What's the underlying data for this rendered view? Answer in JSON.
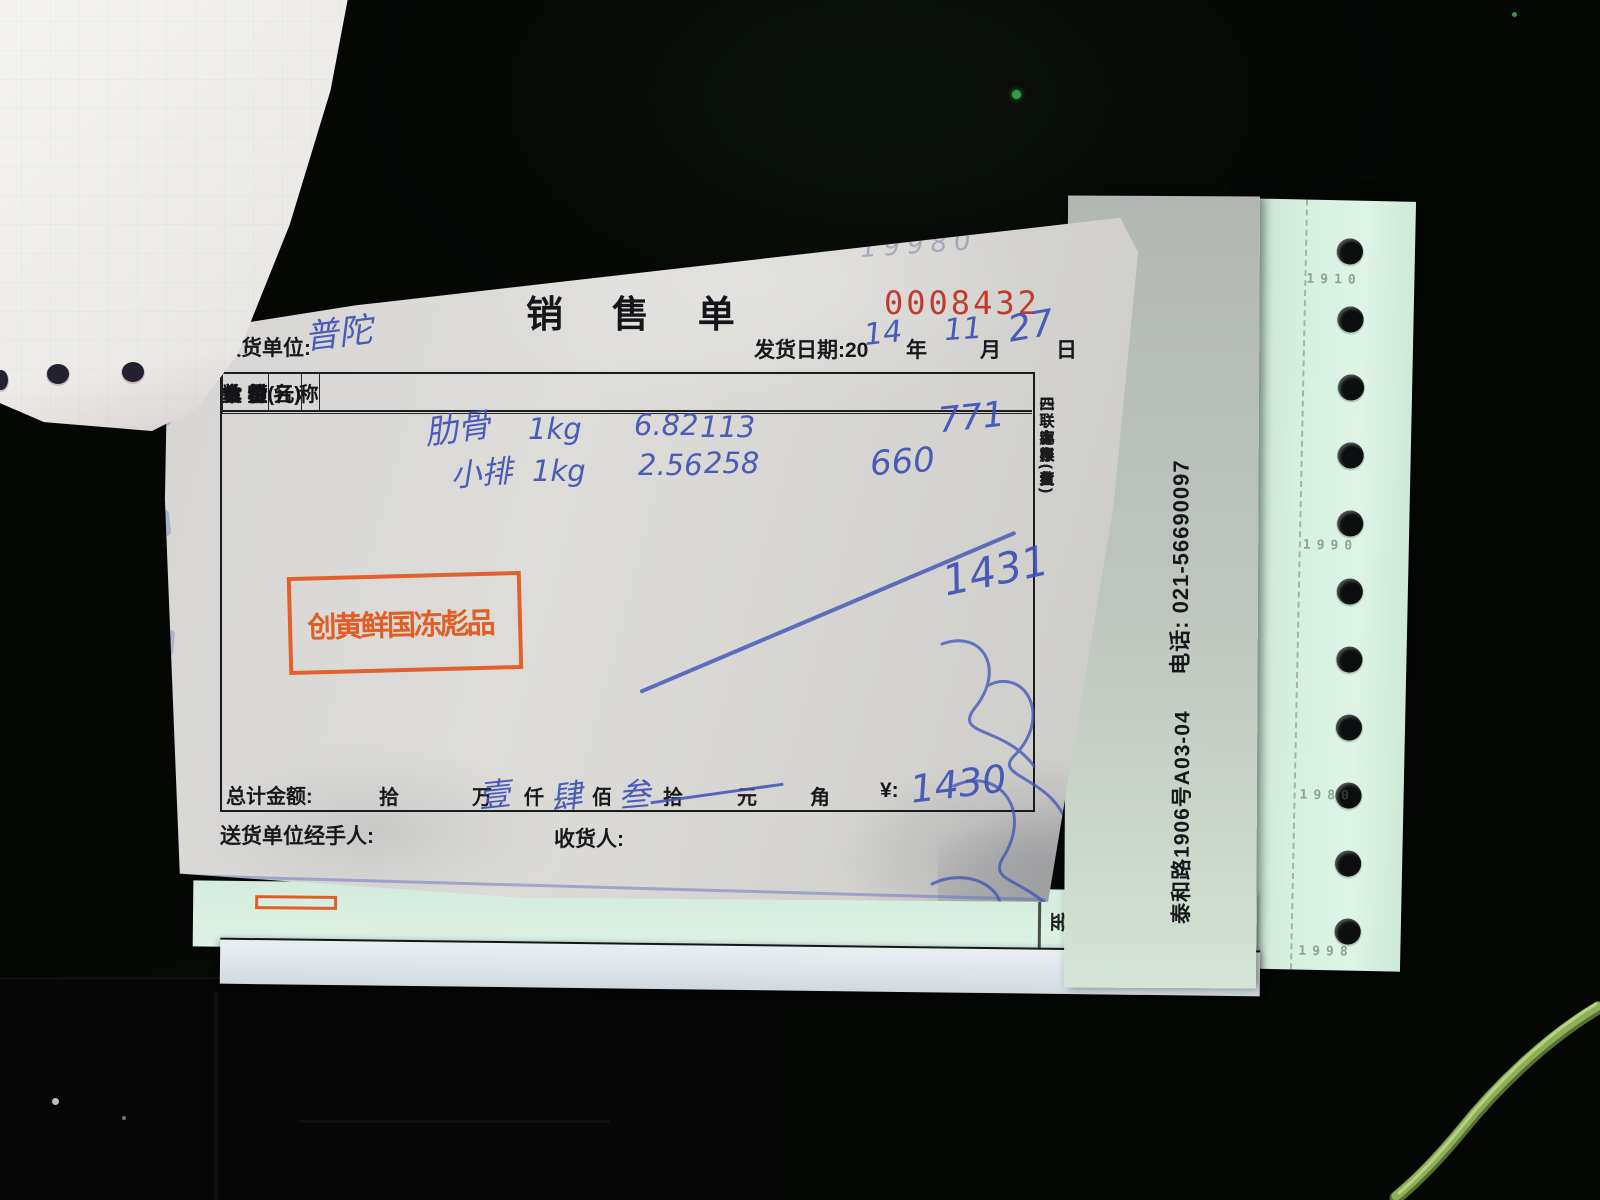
{
  "receipt": {
    "faint_note": "19980",
    "title": "销 售 单",
    "serial": "0008432",
    "consignee_label": "收货单位:",
    "consignee_value": "普陀",
    "date_label": "发货日期:20",
    "date_year": "14",
    "year_char": "年",
    "date_month": "11",
    "month_char": "月",
    "date_day": "27",
    "day_char": "日",
    "table": {
      "headers": [
        "食  材  名  称",
        "单  位",
        "数  量",
        "单 价(元)",
        "金  额(元)"
      ],
      "rows": [
        {
          "name": "肋骨",
          "unit": "1kg",
          "qty": "6.82",
          "price": "113",
          "amount": "771"
        },
        {
          "name": "小排",
          "unit": "1kg",
          "qty": "2.56",
          "price": "258",
          "amount": "660"
        }
      ],
      "subtotal_handwritten": "1431"
    },
    "stamp": {
      "line1": "创 鲜 冻 品",
      "line2": "黄 国 彪"
    },
    "total": {
      "label": "总计金额:",
      "units": [
        "拾",
        "万",
        "仟",
        "佰",
        "拾",
        "元",
        "角"
      ],
      "digit_wan": "壹",
      "digit_qian": "肆",
      "digit_bai": "叁",
      "currency_label": "¥:",
      "currency_value": "1430"
    },
    "footer": {
      "handler_label": "送货单位经手人:",
      "receiver_label": "收货人:"
    },
    "copies": [
      "一联存根(白)",
      "二联库存(红)",
      "三联客户(蓝)",
      "四联记账(黄)"
    ]
  },
  "side_sheet": {
    "phone": "电话: 021-56690097",
    "address": "泰和路1906号A03-04",
    "partial_char_1": "金",
    "partial_char_2": "("
  },
  "tractor_strip": {
    "faint_numbers": [
      "1910",
      "1990",
      "1980",
      "1998"
    ]
  },
  "colors": {
    "stamp_orange": "#e0571e",
    "serial_red": "#c23b30",
    "ink_blue": "#3f51b5",
    "paper": "#d9d8d6",
    "mint": "#d5eedd"
  }
}
